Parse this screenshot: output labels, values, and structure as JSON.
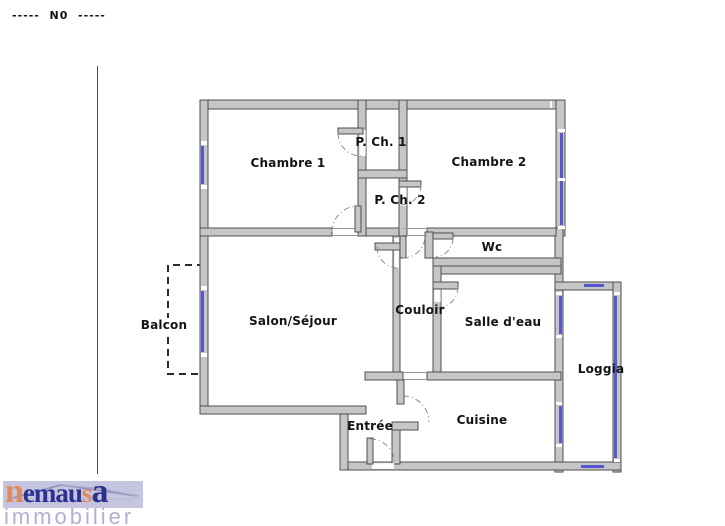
{
  "header": {
    "plan_level_label": "-----  N0  -----"
  },
  "colors": {
    "wall_fill": "#c6c6c6",
    "wall_stroke": "#4f4f4f",
    "window_blue": "#5757d2",
    "logo_banner": "#c5c5df",
    "logo_navy": "#2a3191",
    "logo_orange": "#e08a5e",
    "logo_lavender": "#b0b0d2"
  },
  "plan": {
    "rooms": [
      {
        "id": "chambre1",
        "label": "Chambre 1",
        "x": 288,
        "y": 163,
        "on_white": false
      },
      {
        "id": "pch1",
        "label": "P. Ch. 1",
        "x": 381,
        "y": 142,
        "on_white": false
      },
      {
        "id": "pch2",
        "label": "P. Ch. 2",
        "x": 400,
        "y": 200,
        "on_white": false
      },
      {
        "id": "chambre2",
        "label": "Chambre 2",
        "x": 489,
        "y": 162,
        "on_white": false
      },
      {
        "id": "wc",
        "label": "Wc",
        "x": 492,
        "y": 247,
        "on_white": false
      },
      {
        "id": "salon",
        "label": "Salon/Séjour",
        "x": 293,
        "y": 321,
        "on_white": false
      },
      {
        "id": "couloir",
        "label": "Couloir",
        "x": 420,
        "y": 310,
        "on_white": false
      },
      {
        "id": "salledeau",
        "label": "Salle d'eau",
        "x": 503,
        "y": 322,
        "on_white": false
      },
      {
        "id": "balcon",
        "label": "Balcon",
        "x": 164,
        "y": 325,
        "on_white": true
      },
      {
        "id": "loggia",
        "label": "Loggia",
        "x": 601,
        "y": 369,
        "on_white": false
      },
      {
        "id": "cuisine",
        "label": "Cuisine",
        "x": 482,
        "y": 420,
        "on_white": false
      },
      {
        "id": "entree",
        "label": "Entrée",
        "x": 370,
        "y": 426,
        "on_white": false
      }
    ]
  },
  "logo": {
    "segments": [
      {
        "text": "n",
        "color": "orange",
        "size": "lg"
      },
      {
        "text": "emau",
        "color": "navy",
        "size": "sm"
      },
      {
        "text": "s",
        "color": "orange",
        "size": "sm"
      },
      {
        "text": "a",
        "color": "navy",
        "size": "lg"
      }
    ],
    "subtitle": "immobilier"
  }
}
